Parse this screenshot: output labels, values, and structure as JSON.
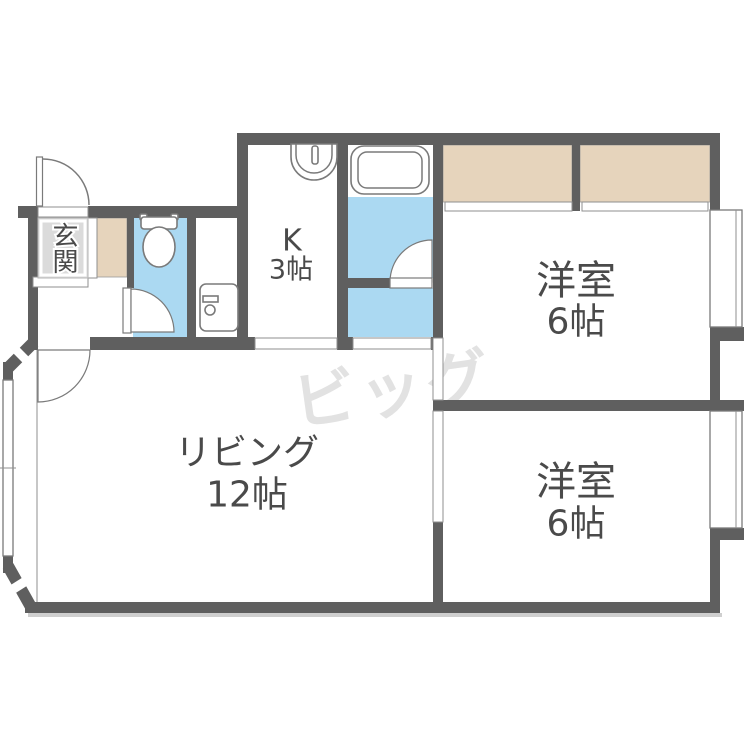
{
  "floorplan": {
    "watermark": {
      "text": "ビッグ"
    },
    "rooms": {
      "genkan": {
        "label": "玄関"
      },
      "kitchen": {
        "name": "K",
        "size": "3帖"
      },
      "bedroom_top": {
        "name": "洋室",
        "size": "6帖"
      },
      "bedroom_bottom": {
        "name": "洋室",
        "size": "6帖"
      },
      "living": {
        "name": "リビング",
        "size": "12帖"
      }
    },
    "fixtures": [
      {
        "icon": "toilet-icon"
      },
      {
        "icon": "bathtub-icon"
      },
      {
        "icon": "kitchen-sink-icon"
      },
      {
        "icon": "washbasin-icon"
      }
    ],
    "colors": {
      "wall": "#5f5f5f",
      "wet_area_blue": "#abd9f2",
      "closet_beige": "#e6d4bc",
      "genkan_gray": "#dbdbdb",
      "watermark_gray": "#e2e2e2",
      "label_text": "#4a4a4a"
    }
  }
}
